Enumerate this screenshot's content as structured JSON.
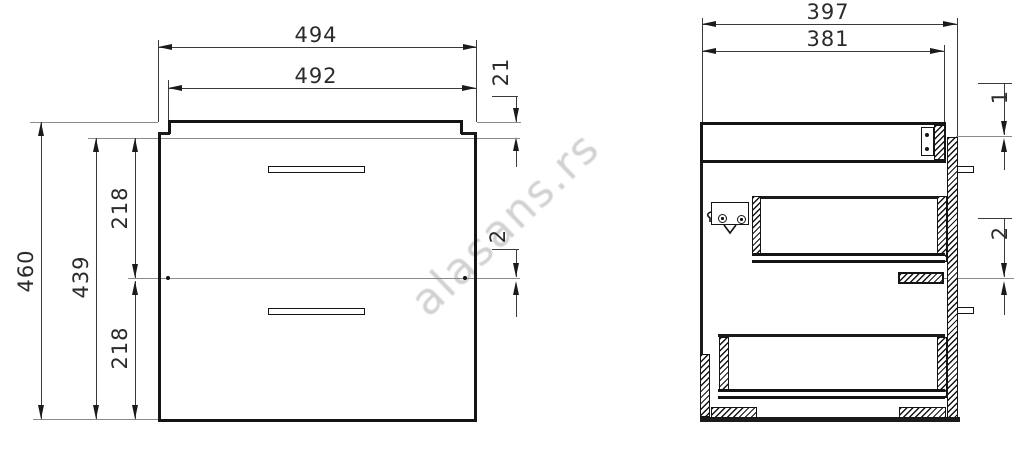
{
  "watermark": "alasans.rs",
  "front_view": {
    "dims": {
      "width_overall": "494",
      "width_carcass": "492",
      "top_thickness": "21",
      "front_gap": "2",
      "height_overall": "460",
      "height_front": "439",
      "drawer_front_top": "218",
      "drawer_front_bottom": "218"
    }
  },
  "side_view": {
    "dims": {
      "depth_overall": "397",
      "depth_carcass": "381",
      "top_gap": "1",
      "middle_gap": "2"
    }
  }
}
